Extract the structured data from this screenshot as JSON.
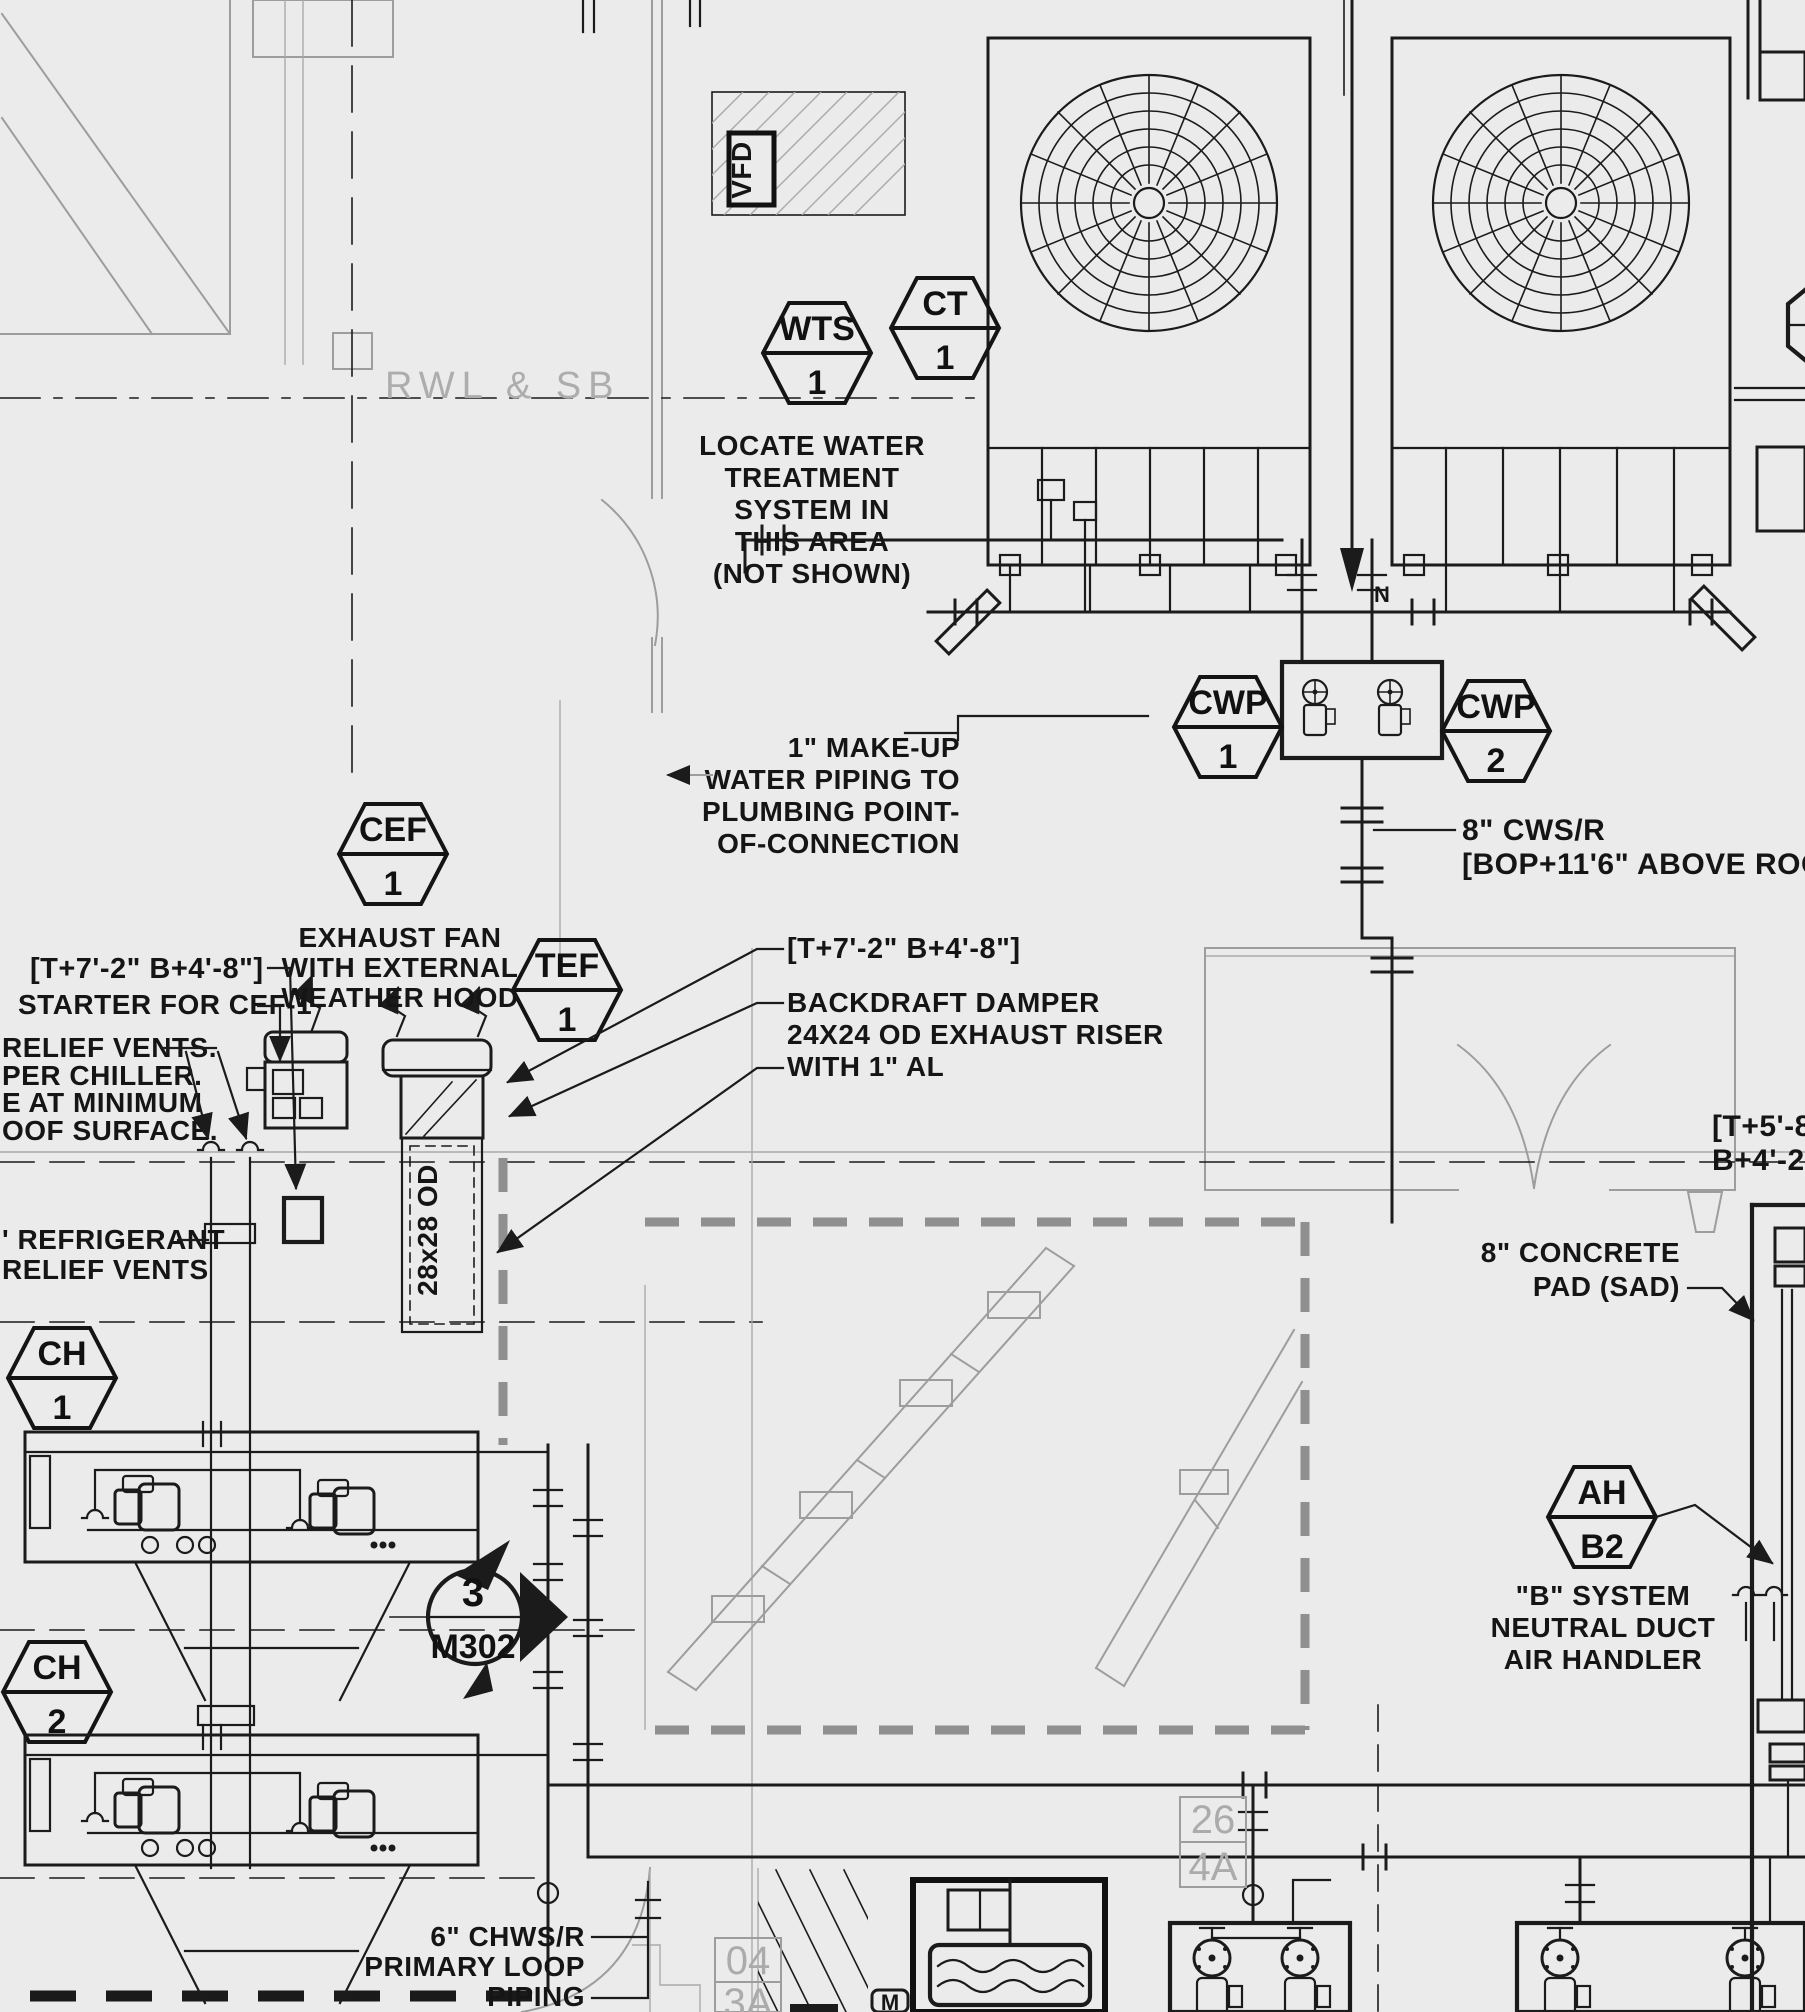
{
  "title": "Mechanical roof plan - chiller / cooling tower piping",
  "colors": {
    "paper": "#ebebeb",
    "ink": "#1b1b1b",
    "faint": "#9d9d9d",
    "grid_gray": "#ababab"
  },
  "tags": {
    "wts": {
      "top": "WTS",
      "bottom": "1"
    },
    "ct": {
      "top": "CT",
      "bottom": "1"
    },
    "cwp1": {
      "top": "CWP",
      "bottom": "1"
    },
    "cwp2": {
      "top": "CWP",
      "bottom": "2"
    },
    "cef": {
      "top": "CEF",
      "bottom": "1"
    },
    "tef": {
      "top": "TEF",
      "bottom": "1"
    },
    "ch1": {
      "top": "CH",
      "bottom": "1"
    },
    "ch2": {
      "top": "CH",
      "bottom": "2"
    },
    "ah": {
      "top": "AH",
      "bottom": "B2"
    }
  },
  "sec": {
    "num": "3",
    "sheet": "M302"
  },
  "grid": {
    "a": "26",
    "b": "4A",
    "c": "04",
    "d": "3A"
  },
  "ann": {
    "rwl": "RWL & SB",
    "vfd": "VFD",
    "north": "N",
    "m": "M",
    "duct": "28x28 OD",
    "locate": [
      "LOCATE WATER",
      "TREATMENT",
      "SYSTEM IN",
      "THIS AREA",
      "(NOT SHOWN)"
    ],
    "makeup": [
      "1\" MAKE-UP",
      "WATER PIPING TO",
      "PLUMBING POINT-",
      "OF-CONNECTION"
    ],
    "cwsr": [
      "8\" CWS/R",
      "[BOP+11'6\" ABOVE ROOF]"
    ],
    "exfan": [
      "EXHAUST FAN",
      "WITH EXTERNAL",
      "WEATHER HOOD"
    ],
    "coords_a": "[T+7'-2\" B+4'-8\"]",
    "starter": "STARTER FOR CEF-1",
    "relief": [
      "RELIEF VENTS.",
      "PER CHILLER.",
      "E AT MINIMUM",
      "OOF SURFACE."
    ],
    "refrig": [
      "' REFRIGERANT",
      "RELIEF VENTS"
    ],
    "coords_b": "[T+7'-2\" B+4'-8\"]",
    "backdraft": [
      "BACKDRAFT DAMPER",
      "24X24 OD EXHAUST RISER",
      "WITH 1\" AL"
    ],
    "pad": [
      "8\" CONCRETE",
      "PAD (SAD)"
    ],
    "coords_c": [
      "[T+5'-8",
      "B+4'-2'"
    ],
    "bsys": [
      "\"B\" SYSTEM",
      "NEUTRAL DUCT",
      "AIR HANDLER"
    ],
    "chws": [
      "6\" CHWS/R",
      "PRIMARY LOOP",
      "PIPING"
    ]
  }
}
